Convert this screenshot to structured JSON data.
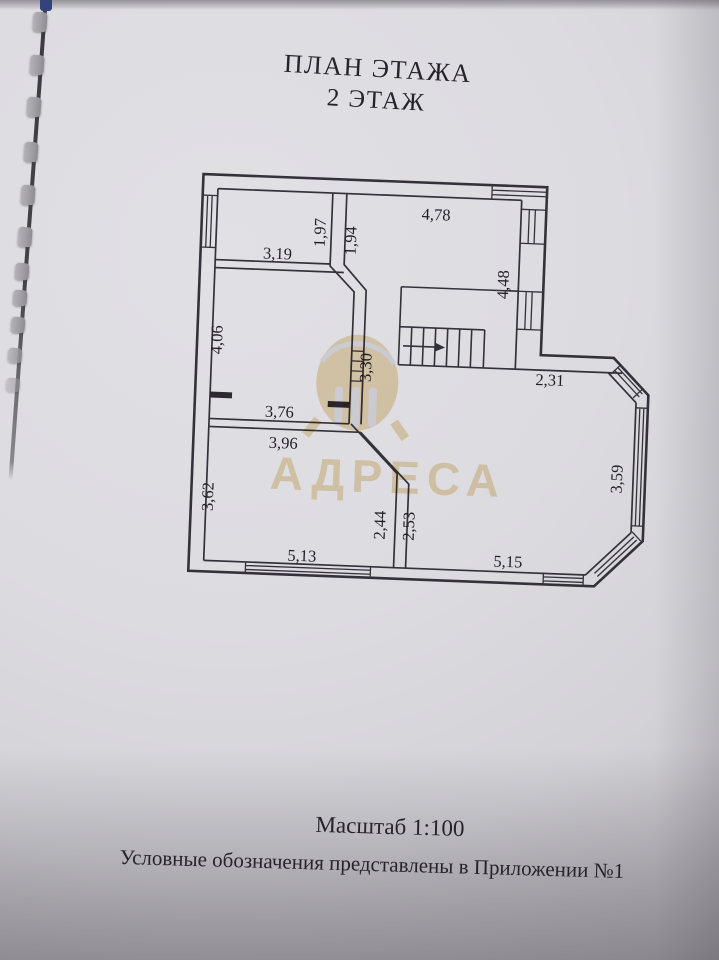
{
  "document": {
    "title": {
      "line1": "ПЛАН ЭТАЖА",
      "line2": "2 ЭТАЖ"
    },
    "notes": {
      "scale": "Масштаб 1:100",
      "legend": "Условные обозначения представлены в Приложении №1"
    }
  },
  "watermark": {
    "text": "АДРЕСА",
    "color": "#e3c98e"
  },
  "floor_plan": {
    "kind": "floor plan drawing, 2nd floor",
    "scale": "1:100",
    "units": "meters",
    "dimensions": {
      "room_top_left_width": "3,19",
      "room_top_left_depth": "1,97",
      "top_partition_depth": "1,94",
      "room_top_right_width": "4,78",
      "right_side_depth": "4,48",
      "room_mid_left_depth": "4,06",
      "mid_wall_depth": "3,30",
      "room_mid_left_width": "3,76",
      "room_bottom_left_top_width": "3,96",
      "room_bottom_left_depth": "3,62",
      "partition_left_depth": "2,44",
      "partition_right_depth": "2,53",
      "room_bottom_left_bottom_width": "5,13",
      "bay_top_width": "2,31",
      "bay_right_depth": "3,59",
      "room_bottom_right_width": "5,15"
    }
  }
}
